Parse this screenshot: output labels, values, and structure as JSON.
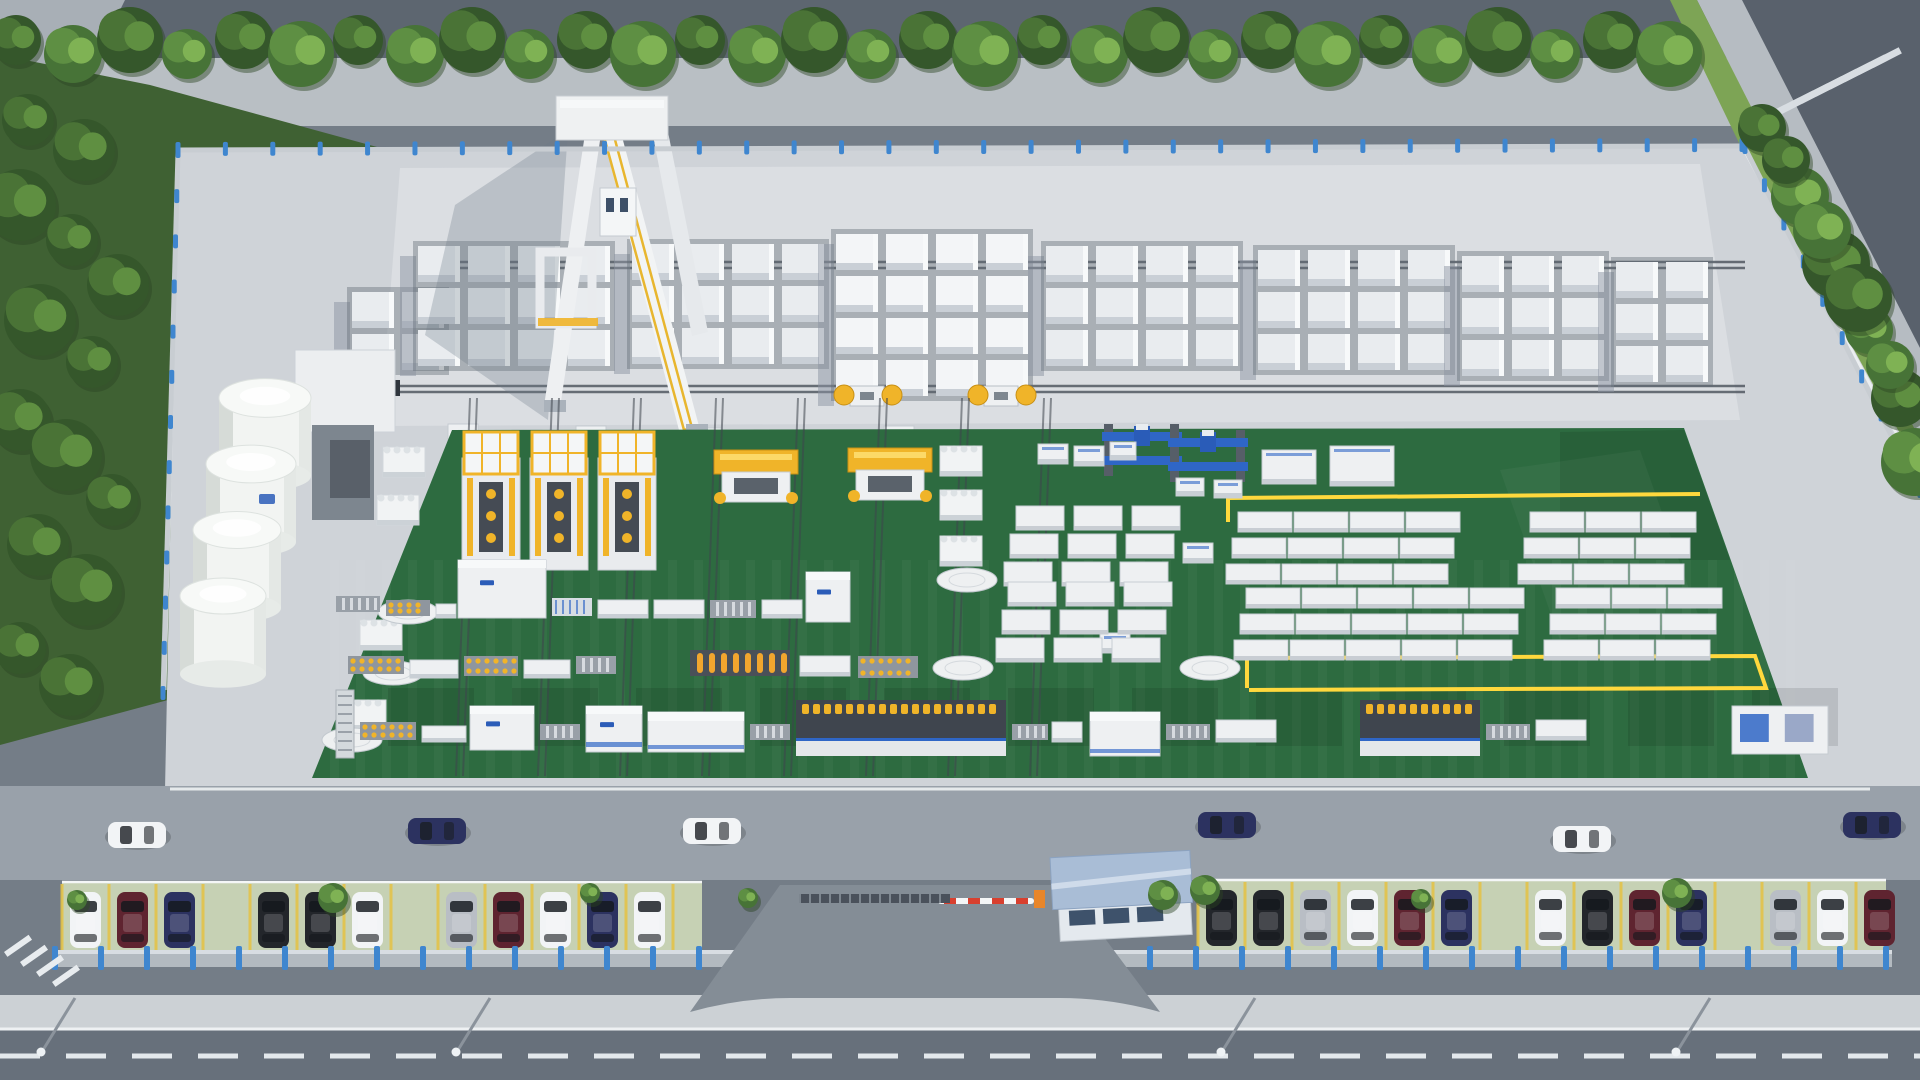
{
  "scene": {
    "type": "aerial-3d-render",
    "subject": "AAC block factory plant with green production floor, block storage yard, silos, gate and parking",
    "palette": {
      "asphalt_outer": "#5d6670",
      "asphalt_main_road": "#67707b",
      "asphalt_inner_road": "#9aa2ab",
      "sidewalk": "#c2c8cd",
      "apron_concrete": "#cfd3d8",
      "apron_bright": "#dfe2e6",
      "green_floor": "#2d6b40",
      "green_patch": "#255c36",
      "grass": "#82a85c",
      "tree_dark": "#3c6130",
      "tree_mid": "#547f3b",
      "tree_light": "#6fa04b",
      "fence_wall": "#b3bac0",
      "fence_post_blue": "#3f86cf",
      "machine_yellow": "#f0b429",
      "machine_blue": "#2f66c6",
      "machine_white": "#eef0f2",
      "machine_dark": "#3f454e",
      "silo_white": "#f2f4f2",
      "block_white": "#e9ecef",
      "block_bright": "#f3f5f7",
      "gate_roof": "#a9bdd6",
      "lane_marking": "#e8ecef",
      "stall_line_yellow": "#e3c34a",
      "floor_marking_yellow": "#ffd83d",
      "barrier_red": "#d8402f",
      "paver_green": "#c6d1b4",
      "logo_blue": "#2b5cb8",
      "car_white": "#f2f4f6",
      "car_black": "#23262b",
      "car_navy": "#2c3260",
      "car_maroon": "#5f2430",
      "car_silver": "#b9bec5"
    },
    "vegetation": {
      "top_row": {
        "count": 30,
        "x_start": 16,
        "spacing": 57,
        "y": 44
      },
      "right_row": [
        [
          1762,
          128
        ],
        [
          1800,
          196
        ],
        [
          1836,
          264
        ],
        [
          1869,
          330
        ],
        [
          1900,
          398
        ],
        [
          1915,
          462
        ],
        [
          1786,
          160
        ],
        [
          1822,
          230
        ],
        [
          1858,
          298
        ],
        [
          1890,
          365
        ]
      ],
      "left_band": [
        [
          28,
          120
        ],
        [
          84,
          150
        ],
        [
          20,
          205
        ],
        [
          72,
          240
        ],
        [
          118,
          285
        ],
        [
          40,
          320
        ],
        [
          92,
          362
        ],
        [
          20,
          420
        ],
        [
          66,
          455
        ],
        [
          112,
          500
        ],
        [
          38,
          545
        ],
        [
          86,
          590
        ],
        [
          20,
          648
        ],
        [
          70,
          685
        ]
      ],
      "parking_bushes": [
        [
          77,
          900
        ],
        [
          333,
          898
        ],
        [
          590,
          893
        ],
        [
          1163,
          895
        ],
        [
          1421,
          899
        ],
        [
          1677,
          893
        ],
        [
          748,
          898
        ],
        [
          1205,
          890
        ]
      ]
    },
    "fences": {
      "top": {
        "x1": 178,
        "y1": 150,
        "x2": 1742,
        "y2": 146,
        "posts": 33
      },
      "left": {
        "x1": 178,
        "y1": 152,
        "x2": 163,
        "y2": 694,
        "posts": 12
      },
      "right": {
        "x1": 1745,
        "y1": 148,
        "x2": 1920,
        "y2": 492,
        "posts": 9
      },
      "front_left": {
        "x": 55,
        "y": 950,
        "w": 740
      },
      "front_right": {
        "x": 1058,
        "y": 950,
        "w": 834
      }
    },
    "storage_yard": {
      "rails": [
        {
          "x1": 430,
          "y": 262,
          "x2": 1745
        },
        {
          "x1": 400,
          "y": 386,
          "x2": 1745
        }
      ],
      "vertical_rails_x": [
        470,
        552,
        634,
        716,
        798,
        880,
        962,
        1044
      ],
      "groups": [
        {
          "x": 352,
          "y": 292,
          "cols": 2,
          "rows": 2,
          "bright": false
        },
        {
          "x": 418,
          "y": 246,
          "cols": 4,
          "rows": 3,
          "bright": false
        },
        {
          "x": 632,
          "y": 244,
          "cols": 4,
          "rows": 3,
          "bright": false
        },
        {
          "x": 836,
          "y": 234,
          "cols": 4,
          "rows": 4,
          "bright": true
        },
        {
          "x": 1046,
          "y": 246,
          "cols": 4,
          "rows": 3,
          "bright": false
        },
        {
          "x": 1258,
          "y": 250,
          "cols": 4,
          "rows": 3,
          "bright": false
        },
        {
          "x": 1462,
          "y": 256,
          "cols": 3,
          "rows": 3,
          "bright": false
        },
        {
          "x": 1616,
          "y": 262,
          "cols": 2,
          "rows": 3,
          "bright": false
        }
      ],
      "ferry_cars": [
        [
          836,
          384
        ],
        [
          970,
          384
        ]
      ],
      "small_pallets": [
        [
          448,
          424
        ],
        [
          512,
          430
        ],
        [
          576,
          426
        ],
        [
          692,
          428
        ],
        [
          748,
          432
        ],
        [
          884,
          426
        ],
        [
          948,
          430
        ]
      ]
    },
    "silos": {
      "count": 4,
      "top_cx": 265,
      "top_cy": 398,
      "dx": -14,
      "dy": 66,
      "r": 46
    },
    "green_floor": {
      "polygon": "452,430 1684,428 1808,778 312,778",
      "yellow_lines": [
        "M 1228,522 L 1228,498 L 1700,494",
        "M 1247,688 L 1247,658 L 1755,656 L 1766,688 L 1249,690"
      ],
      "dark_patches_row": {
        "y": 688,
        "h": 58,
        "x_start": 388,
        "step": 124,
        "w": 86,
        "count": 12
      },
      "corner_patch": "1560,432 1684,430 1730,560 1560,560"
    },
    "machines": {
      "cutting_lines": [
        [
          462,
          432
        ],
        [
          530,
          432
        ],
        [
          598,
          432
        ]
      ],
      "tilting_cranes": [
        [
          714,
          450
        ],
        [
          848,
          448
        ]
      ],
      "blue_gantries": [
        [
          1104,
          424
        ],
        [
          1170,
          430
        ]
      ],
      "white_tables_topright": [
        [
          1262,
          450,
          54,
          34
        ],
        [
          1330,
          446,
          64,
          40
        ],
        [
          1176,
          478,
          28,
          18
        ],
        [
          1214,
          480,
          28,
          18
        ]
      ],
      "misc_small": [
        [
          1038,
          444,
          30,
          20
        ],
        [
          1074,
          446,
          30,
          20
        ],
        [
          1110,
          442,
          26,
          18
        ],
        [
          1183,
          543,
          30,
          20
        ],
        [
          1100,
          633,
          30,
          20
        ]
      ]
    },
    "cakes": [
      [
        383,
        447
      ],
      [
        377,
        495
      ],
      [
        360,
        620
      ],
      [
        344,
        700
      ],
      [
        940,
        446
      ],
      [
        940,
        490
      ],
      [
        940,
        536
      ]
    ],
    "turntables": [
      [
        967,
        580
      ],
      [
        963,
        668
      ],
      [
        1210,
        668
      ],
      [
        408,
        612
      ],
      [
        393,
        673
      ],
      [
        352,
        740
      ]
    ],
    "mould_rows": {
      "band1": {
        "y": 512,
        "xs": [
          1238,
          1294,
          1350,
          1406,
          1530,
          1586,
          1642
        ]
      },
      "band2": {
        "y": 588,
        "xs": [
          1246,
          1302,
          1358,
          1414,
          1470,
          1556,
          1612,
          1668
        ]
      },
      "center1": {
        "y": 506,
        "xs": [
          1016,
          1074,
          1132
        ]
      },
      "center2": {
        "y": 582,
        "xs": [
          1008,
          1066,
          1124
        ]
      }
    },
    "conveyors": {
      "line_a": [
        [
          336,
          596,
          44,
          16,
          "roller"
        ],
        [
          386,
          600,
          44,
          16,
          "rollerY"
        ],
        [
          436,
          604,
          20,
          14,
          "table"
        ],
        [
          458,
          560,
          88,
          58,
          "cabinet"
        ],
        [
          552,
          598,
          40,
          18,
          "bluebox"
        ],
        [
          598,
          600,
          50,
          18,
          "table"
        ],
        [
          654,
          600,
          50,
          18,
          "table"
        ],
        [
          710,
          600,
          46,
          18,
          "roller"
        ],
        [
          762,
          600,
          40,
          18,
          "table"
        ],
        [
          806,
          572,
          44,
          50,
          "cabinet"
        ]
      ],
      "line_a2": [
        [
          348,
          656,
          56,
          18,
          "rollerY"
        ],
        [
          410,
          660,
          48,
          18,
          "table"
        ],
        [
          464,
          656,
          54,
          20,
          "rollerY"
        ],
        [
          524,
          660,
          46,
          18,
          "table"
        ],
        [
          576,
          656,
          40,
          18,
          "roller"
        ],
        [
          690,
          650,
          100,
          26,
          "coilbank"
        ],
        [
          800,
          656,
          50,
          20,
          "table"
        ],
        [
          858,
          656,
          60,
          22,
          "rollerY"
        ]
      ],
      "line_b": [
        [
          336,
          690,
          18,
          68,
          "rack"
        ],
        [
          360,
          722,
          56,
          18,
          "rollerY"
        ],
        [
          422,
          726,
          44,
          16,
          "table"
        ],
        [
          470,
          706,
          64,
          44,
          "cabinet"
        ],
        [
          540,
          724,
          40,
          16,
          "roller"
        ],
        [
          586,
          706,
          56,
          46,
          "cabinet2"
        ],
        [
          648,
          712,
          96,
          40,
          "machineW"
        ],
        [
          750,
          724,
          40,
          16,
          "roller"
        ],
        [
          796,
          700,
          210,
          56,
          "machineY"
        ],
        [
          1012,
          724,
          36,
          16,
          "roller"
        ],
        [
          1052,
          722,
          30,
          20,
          "table"
        ],
        [
          1090,
          712,
          70,
          44,
          "machineW"
        ],
        [
          1166,
          724,
          44,
          16,
          "roller"
        ],
        [
          1216,
          720,
          60,
          22,
          "table"
        ],
        [
          1360,
          700,
          120,
          56,
          "machineY"
        ],
        [
          1486,
          724,
          44,
          16,
          "roller"
        ],
        [
          1536,
          720,
          50,
          20,
          "table"
        ],
        [
          1732,
          706,
          96,
          48,
          "machineB"
        ]
      ]
    },
    "parking": {
      "left": {
        "x": 62,
        "y": 882,
        "w": 640,
        "h": 76,
        "stall_step": 47,
        "cars": [
          [
            "white",
            0
          ],
          [
            "maroon",
            1
          ],
          [
            "navy",
            2
          ],
          [
            "black",
            4
          ],
          [
            "black",
            5
          ],
          [
            "white",
            6
          ],
          [
            "silver",
            8
          ],
          [
            "maroon",
            9
          ],
          [
            "white",
            10
          ],
          [
            "navy",
            11
          ],
          [
            "white",
            12
          ]
        ]
      },
      "right": {
        "x": 1198,
        "y": 880,
        "w": 688,
        "h": 76,
        "stall_step": 47,
        "cars": [
          [
            "black",
            0
          ],
          [
            "black",
            1
          ],
          [
            "silver",
            2
          ],
          [
            "white",
            3
          ],
          [
            "maroon",
            4
          ],
          [
            "navy",
            5
          ],
          [
            "white",
            7
          ],
          [
            "black",
            8
          ],
          [
            "maroon",
            9
          ],
          [
            "navy",
            10
          ],
          [
            "silver",
            12
          ],
          [
            "white",
            13
          ],
          [
            "maroon",
            14
          ]
        ]
      }
    },
    "road_vehicles": [
      [
        108,
        822,
        "white"
      ],
      [
        408,
        818,
        "navy"
      ],
      [
        683,
        818,
        "white"
      ],
      [
        1198,
        812,
        "navy"
      ],
      [
        1553,
        826,
        "white"
      ],
      [
        1843,
        812,
        "navy"
      ]
    ],
    "gate": {
      "house": {
        "x": 1052,
        "y": 854,
        "w": 140,
        "h": 86,
        "windows": 3
      },
      "barrier": {
        "x": 938,
        "y": 898,
        "len": 96,
        "stripes": 4
      },
      "sliding_gate": {
        "x": 800,
        "y": 894,
        "w": 150
      }
    },
    "main_road": {
      "edge_line_y": 1028,
      "dash_y": 1056,
      "dash": "40 26"
    },
    "crosswalk": {
      "cx": 1770,
      "cy": 112,
      "stripes": 10,
      "step_x": 14.3,
      "step_y": -7.2,
      "angle": 63
    },
    "streetlights_x": [
      75,
      490,
      1255,
      1710
    ]
  }
}
